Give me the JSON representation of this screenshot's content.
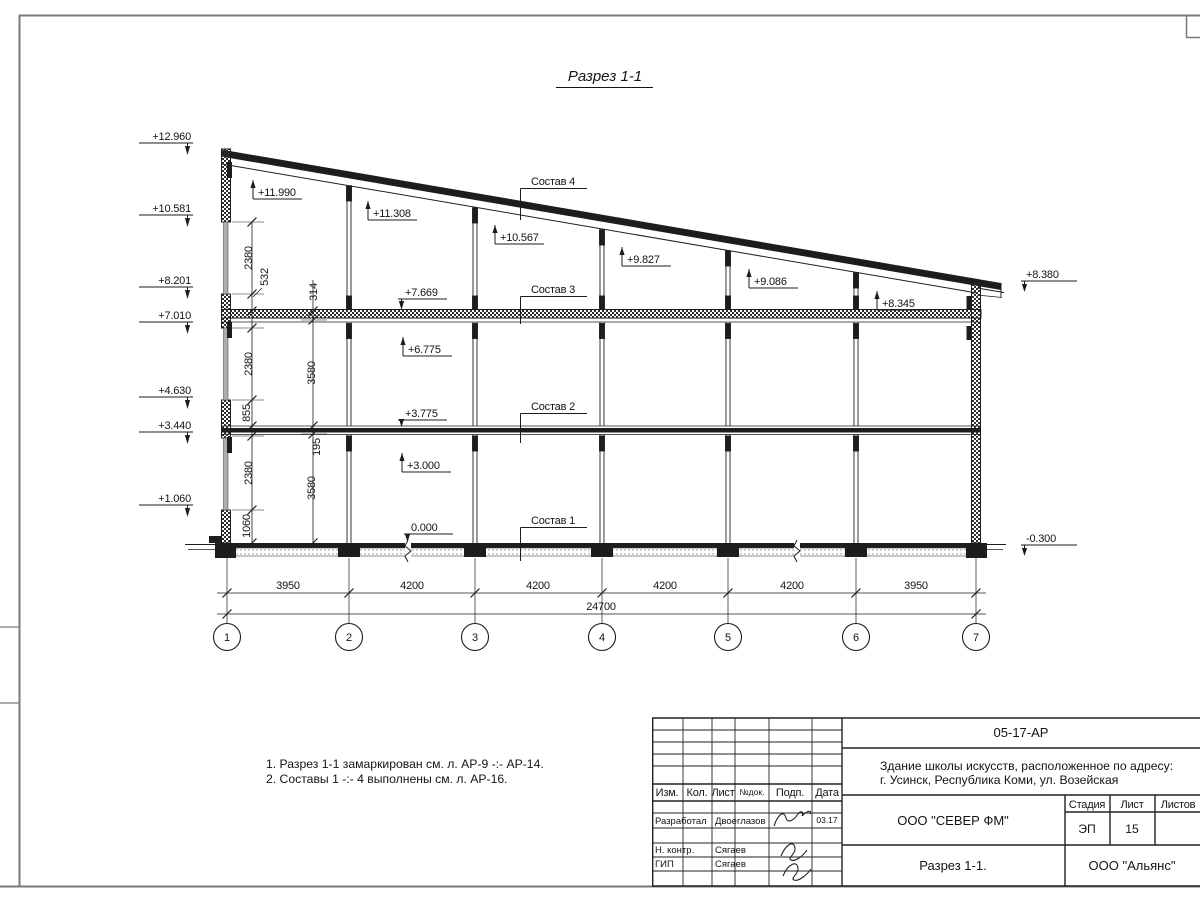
{
  "colors": {
    "line": "#1d1d1d",
    "frame": "#7a7a7a"
  },
  "drawing": {
    "section_title": "Разрез 1-1",
    "left_elevations": [
      "+12.960",
      "+10.581",
      "+8.201",
      "+7.010",
      "+4.630",
      "+3.440",
      "+1.060"
    ],
    "right_elevations": [
      "+8.380",
      "-0.300"
    ],
    "interior_up": [
      "+11.990",
      "+11.308",
      "+10.567",
      "+9.827",
      "+9.086",
      "+8.345",
      "+6.775",
      "+3.000"
    ],
    "interior_down": [
      "+7.669",
      "+3.775",
      "0.000"
    ],
    "layer_labels": [
      "Состав 4",
      "Состав 3",
      "Состав 2",
      "Состав 1"
    ],
    "vdims_outer": [
      "2380",
      "532",
      "2380",
      "855",
      "2380",
      "1060"
    ],
    "vdims_inner": [
      "314",
      "3580",
      "195",
      "3580"
    ],
    "hdims": [
      "3950",
      "4200",
      "4200",
      "4200",
      "4200",
      "3950"
    ],
    "total_dim": "24700",
    "grid_labels": [
      "1",
      "2",
      "3",
      "4",
      "5",
      "6",
      "7"
    ]
  },
  "notes": {
    "line1": "1. Разрез 1-1 замаркирован см. л. АР-9 -:- АР-14.",
    "line2": "2. Составы 1 -:- 4 выполнены см. л. АР-16."
  },
  "title_block": {
    "doc_number": "05-17-АР",
    "project_line1": "Здание школы искусств, расположенное по адресу:",
    "project_line2": "г. Усинск, Республика Коми, ул. Возейская",
    "col_izm": "Изм.",
    "col_kol": "Кол.",
    "col_list": "Лист",
    "col_ndok": "№док.",
    "col_podp": "Подп.",
    "col_data": "Дата",
    "row1_role": "Разработал",
    "row1_name": "Двоеглазов",
    "row1_date": "03.17",
    "row2_role": "Н. контр.",
    "row2_name": "Сягаев",
    "row3_role": "ГИП",
    "row3_name": "Сягаев",
    "company": "ООО \"СЕВЕР ФМ\"",
    "stage_label": "Стадия",
    "stage_value": "ЭП",
    "sheet_label": "Лист",
    "sheet_value": "15",
    "sheets_label": "Листов",
    "sheet_title": "Разрез 1-1.",
    "contractor": "ООО \"Альянс\""
  }
}
